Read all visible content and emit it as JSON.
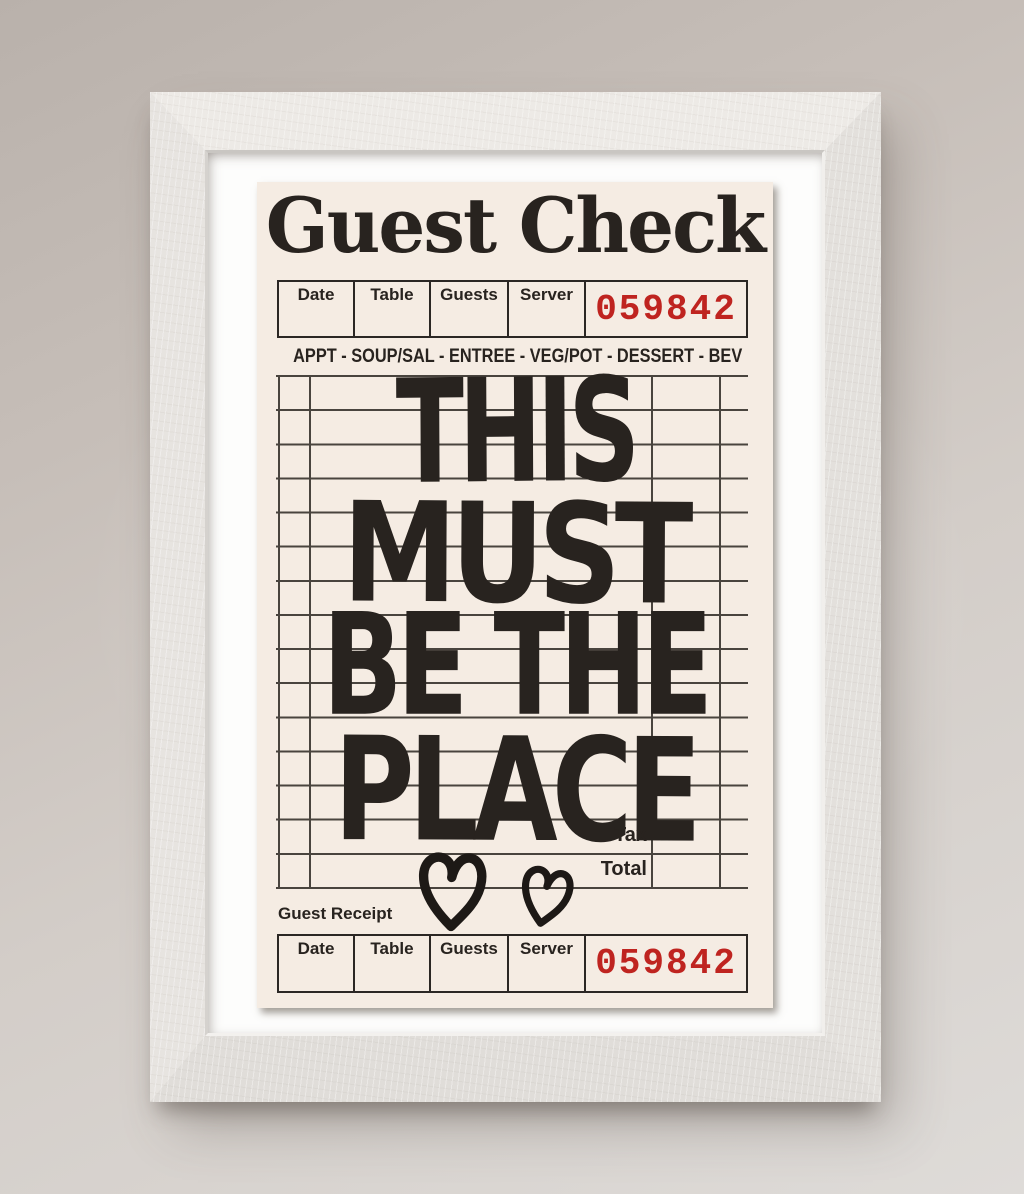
{
  "poster": {
    "title": "Guest Check",
    "check_number": "059842",
    "menu_line": "APPT - SOUP/SAL - ENTREE - VEG/POT - DESSERT - BEV",
    "header_columns": [
      "Date",
      "Table",
      "Guests",
      "Server"
    ],
    "phrase_lines": [
      "THIS",
      "MUST",
      "BE THE",
      "PLACE"
    ],
    "tax_label": "Tax",
    "total_label": "Total",
    "receipt_section": {
      "label": "Guest Receipt",
      "columns": [
        "Date",
        "Table",
        "Guests",
        "Server"
      ],
      "check_number": "059842"
    },
    "icons": [
      "heart-icon-large",
      "heart-icon-small"
    ],
    "colors": {
      "paper": "#f5ece3",
      "ink": "#28231f",
      "check_number_red": "#bf2420",
      "grid_line": "#49443e"
    }
  },
  "frame": {
    "colors": {
      "frame_wood": "#e9e6e2",
      "mat": "#fdfdfc",
      "wall_top": "#b9b1ab",
      "wall_bottom": "#dedbd8"
    }
  }
}
